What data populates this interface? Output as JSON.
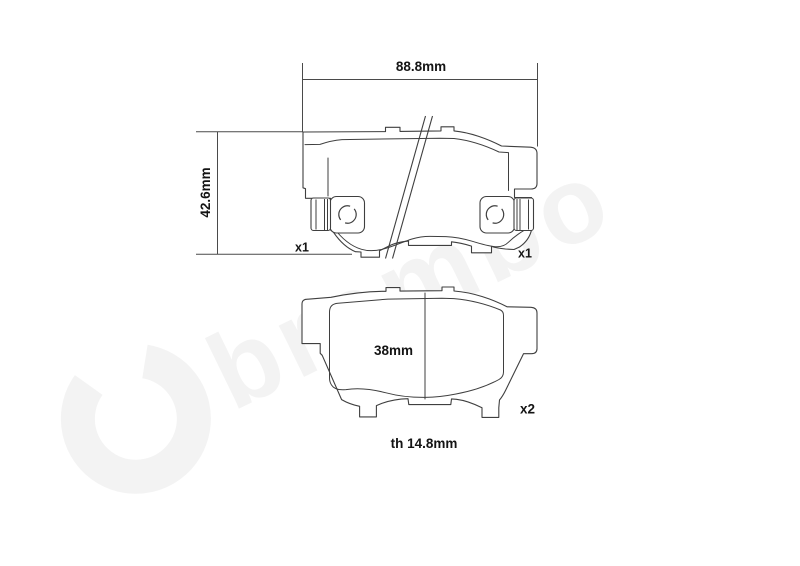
{
  "watermark": {
    "text": "brembo"
  },
  "views": {
    "back_view": {
      "dim_width": "88.8mm",
      "dim_height": "42.6mm",
      "qty_left": "x1",
      "qty_right": "x1"
    },
    "friction_view": {
      "dim_pad_height": "38mm",
      "qty": "x2",
      "dim_thickness": "th 14.8mm"
    }
  },
  "colors": {
    "background": "#ffffff",
    "line": "#3f3f3f",
    "label": "#141414",
    "watermark": "#f3f3f3"
  }
}
